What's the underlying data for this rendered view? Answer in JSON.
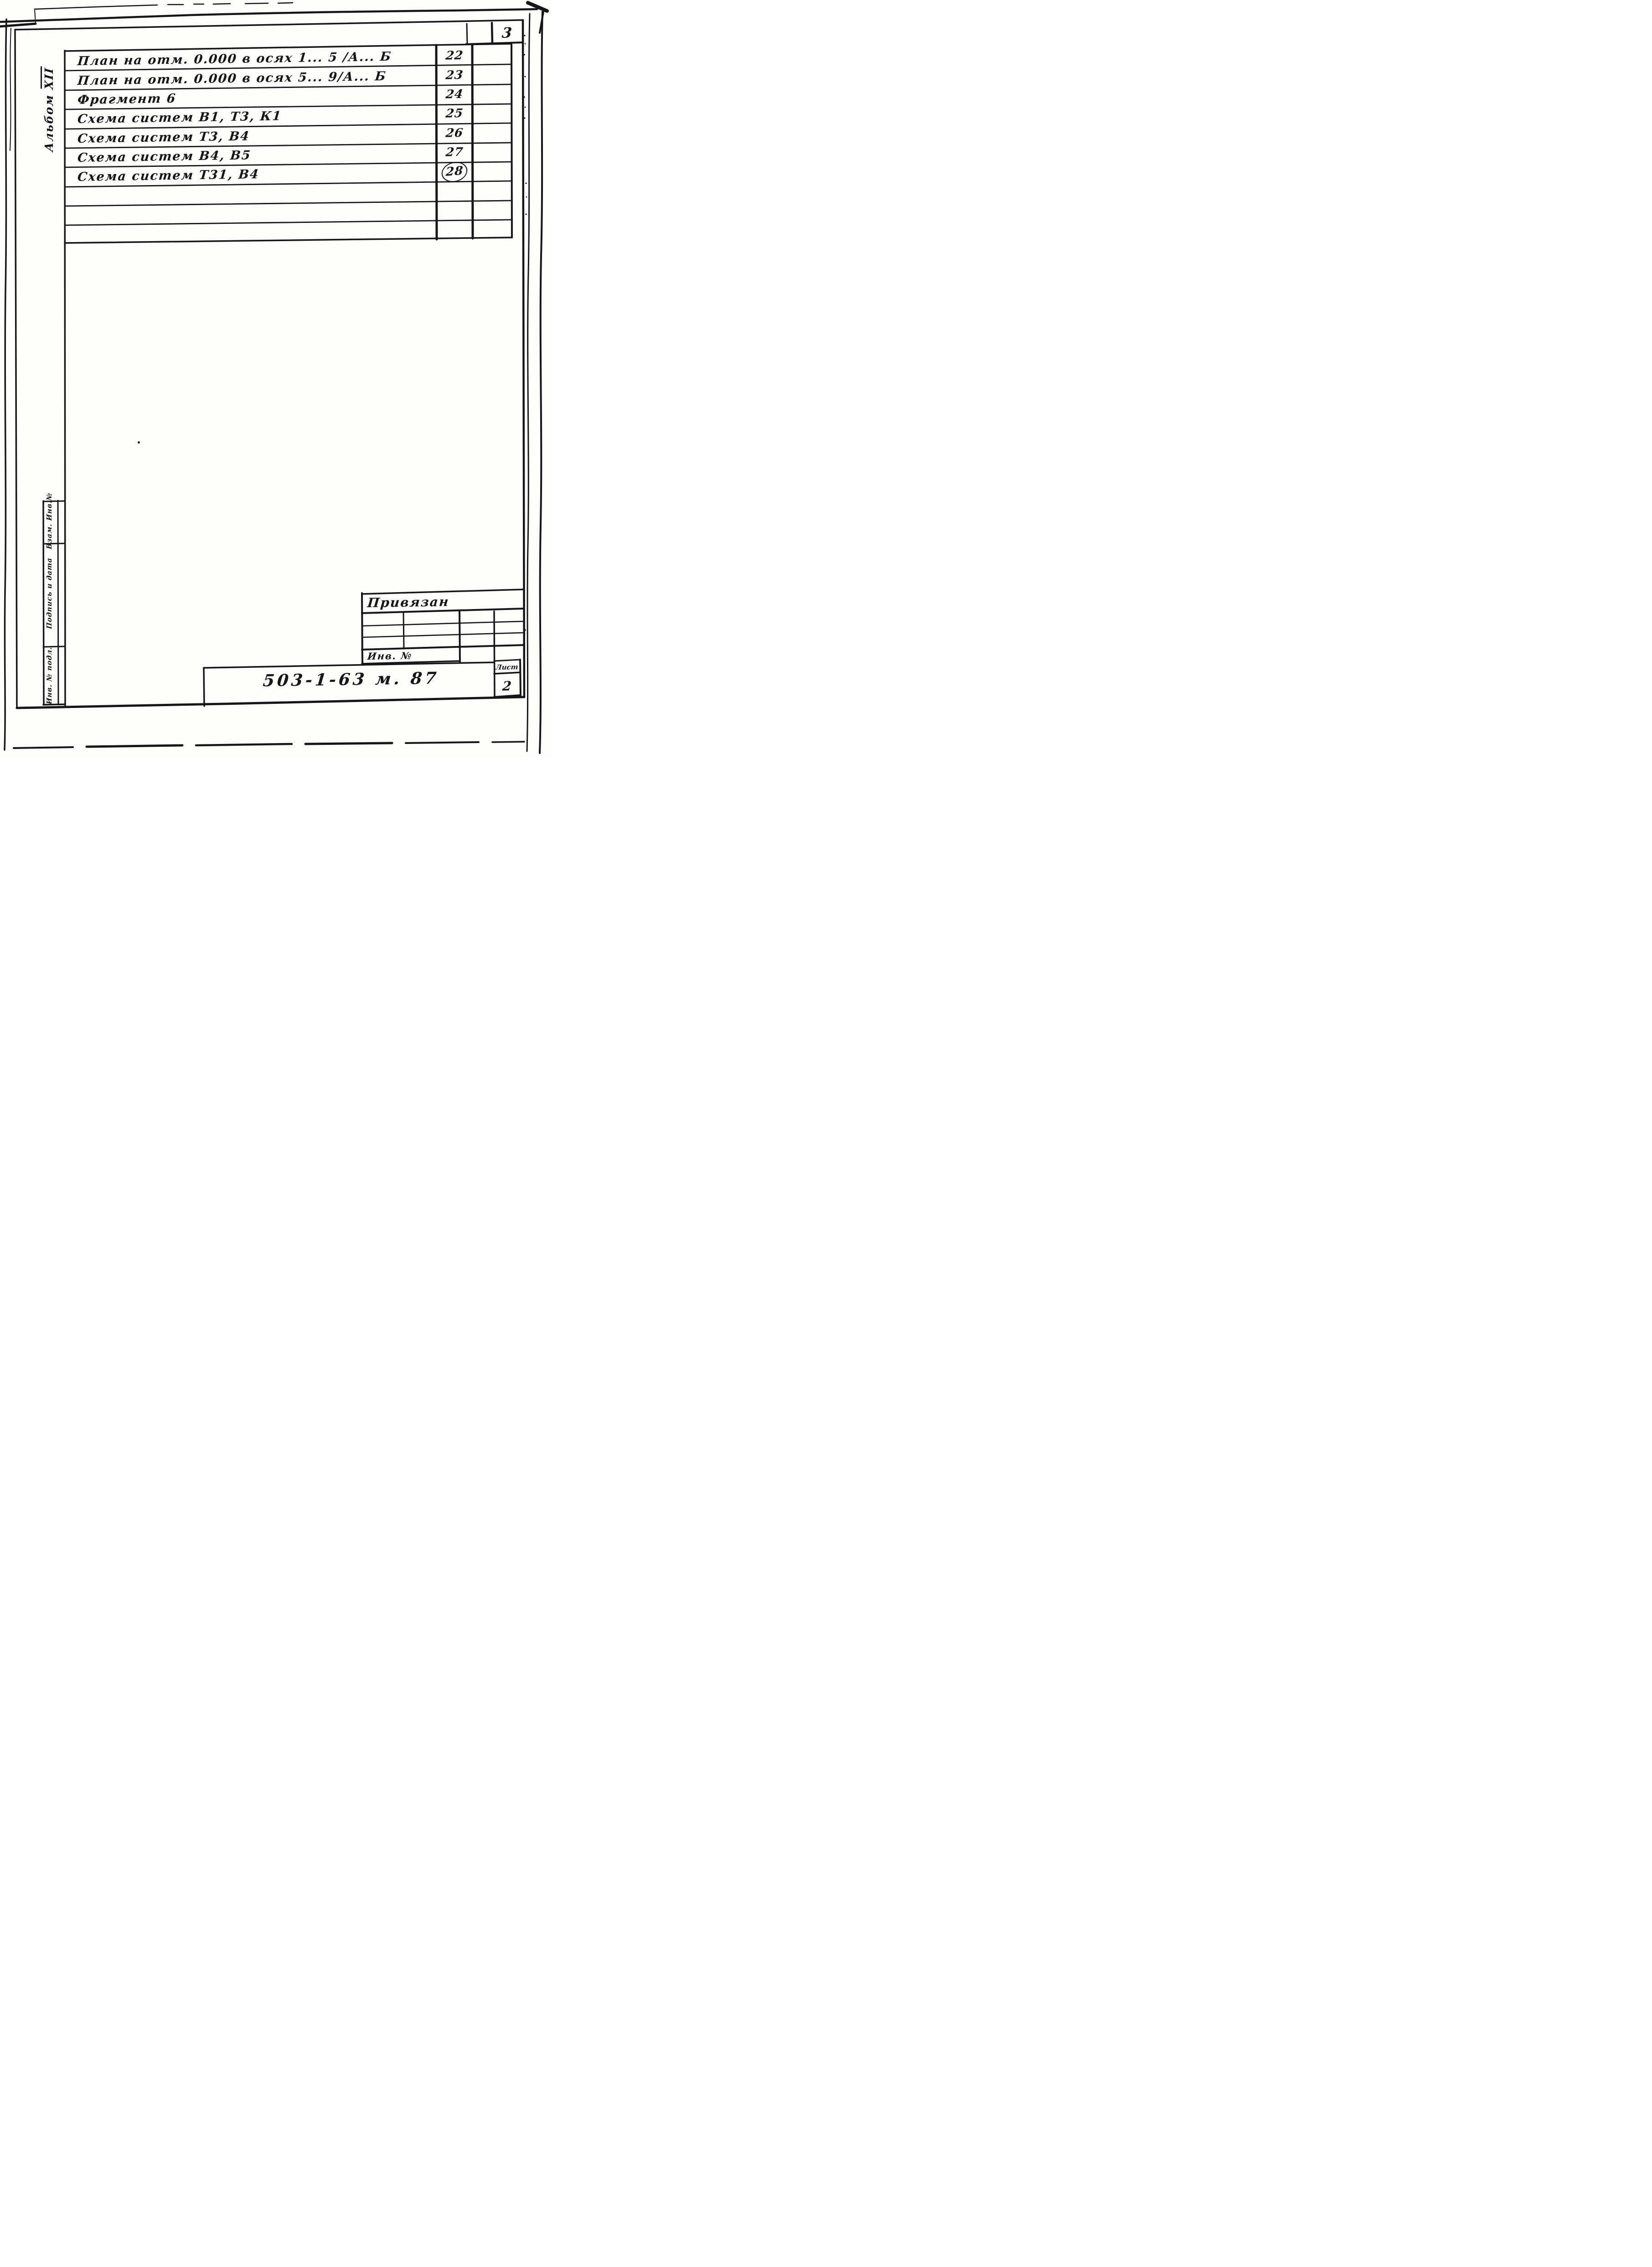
{
  "page": {
    "number": "3"
  },
  "album": {
    "word": "Альбом",
    "numeral": "XII"
  },
  "contents_table": {
    "rows": [
      {
        "title": "План на отм. 0.000  в осях  1... 5 /А... Б",
        "sheet": "22",
        "circled": false
      },
      {
        "title": "План на отм. 0.000  в осях 5... 9/А... Б",
        "sheet": "23",
        "circled": false
      },
      {
        "title": "Фрагмент  6",
        "sheet": "24",
        "circled": false
      },
      {
        "title": "Схема  систем  В1, Т3, К1",
        "sheet": "25",
        "circled": false
      },
      {
        "title": "Схема  систем  Т3,  В4",
        "sheet": "26",
        "circled": false
      },
      {
        "title": "Схема  систем  В4,  В5",
        "sheet": "27",
        "circled": false
      },
      {
        "title": "Схема  систем  Т31,  В4",
        "sheet": "28",
        "circled": true
      }
    ],
    "empty_row_count": 3
  },
  "margin_stamp": {
    "cells": [
      "Взам. Инв.№",
      "Подпись и дата",
      "Инв. № подл."
    ]
  },
  "title_block": {
    "status": "Привязан",
    "inventory_label": "Инв.  №",
    "document_number": "503-1-63 м. 87",
    "sheet_label": "Лист",
    "sheet_number": "2"
  },
  "colors": {
    "ink": "#161616",
    "paper": "#fdfdfb"
  }
}
